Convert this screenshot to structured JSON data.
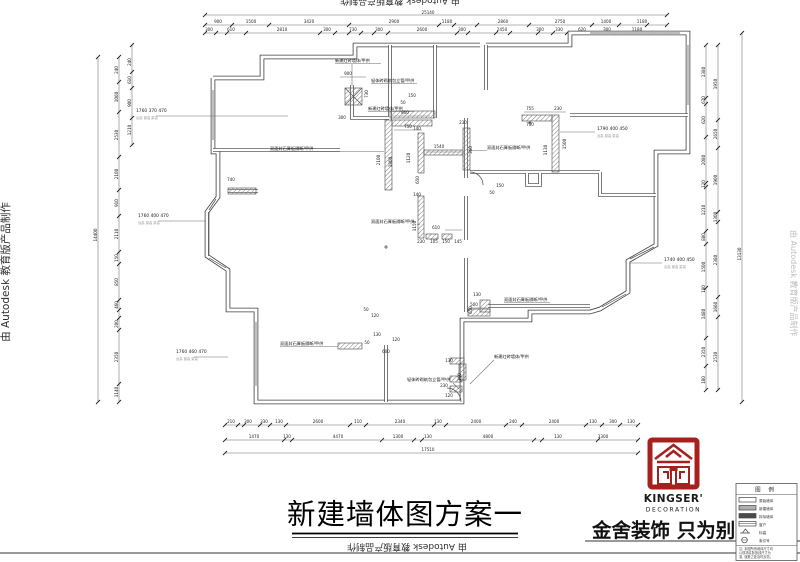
{
  "watermark": {
    "left": "由 Autodesk 教育版产品制作",
    "right": "由 Autodesk 教育版产品制作",
    "top": "由 Autodesk 教育版产品制作",
    "bottom": "由 Autodesk 教育版产品制作"
  },
  "titleblock": {
    "title": "新建墙体图方案一"
  },
  "brand": {
    "name": "KINGSER'",
    "sub": "DECORATION",
    "slogan": "金舍装饰 只为别墅而生",
    "logo_color": "#a8201e"
  },
  "legend": {
    "header": "图 例",
    "rows": [
      "原始墙体",
      "新建墙体",
      "拆除墙体",
      "窗户",
      "标高",
      "索引号"
    ],
    "note1": "注: 本图所有墙体尺寸均",
    "note2": "以现场实际放线尺寸为",
    "note3": "准, 误差之处及时反馈。"
  },
  "plan": {
    "wall_labels": [
      {
        "t": "新建红砖墙体/甲供",
        "x": 335,
        "y": 62
      },
      {
        "t": "轻体砖砌筑包立管/甲供",
        "x": 371,
        "y": 82
      },
      {
        "t": "新建红砖墙体/甲供",
        "x": 368,
        "y": 110
      },
      {
        "t": "双面封石膏板隔断/甲供",
        "x": 270,
        "y": 150
      },
      {
        "t": "双面封石膏板隔断/甲供",
        "x": 487,
        "y": 149
      },
      {
        "t": "双面封石膏板隔断/甲供",
        "x": 371,
        "y": 223
      },
      {
        "t": "双面封石膏板隔断/甲供",
        "x": 504,
        "y": 301
      },
      {
        "t": "双面封石膏板隔断/甲供",
        "x": 280,
        "y": 345
      },
      {
        "t": "新建红砖墙体/甲供",
        "x": 494,
        "y": 358
      },
      {
        "t": "轻体砖砌筑包立管/甲供",
        "x": 407,
        "y": 381
      }
    ],
    "callout_nums": [
      {
        "t": "1760 370 470",
        "x": 136,
        "y": 112
      },
      {
        "t": "1760 400 470",
        "x": 138,
        "y": 217
      },
      {
        "t": "1760 460 470",
        "x": 176,
        "y": 353
      },
      {
        "t": "1790 400 450",
        "x": 597,
        "y": 130
      },
      {
        "t": "1740 400 450",
        "x": 664,
        "y": 261
      }
    ],
    "callout_subs": [
      {
        "t": "台高 窗高 梁高",
        "x": 136,
        "y": 119
      },
      {
        "t": "台高 窗高 梁高",
        "x": 138,
        "y": 224
      },
      {
        "t": "台高 窗高 梁高",
        "x": 176,
        "y": 360
      },
      {
        "t": "台高 窗高 梁高",
        "x": 597,
        "y": 137
      },
      {
        "t": "台高 窗高 梁高",
        "x": 664,
        "y": 268
      }
    ],
    "dims_top": [
      {
        "t": "25140",
        "x": 428,
        "y": 14
      },
      {
        "t": "900",
        "x": 218,
        "y": 23
      },
      {
        "t": "1500",
        "x": 251,
        "y": 23
      },
      {
        "t": "3420",
        "x": 309,
        "y": 23
      },
      {
        "t": "2900",
        "x": 394,
        "y": 23
      },
      {
        "t": "1180",
        "x": 447,
        "y": 23
      },
      {
        "t": "2860",
        "x": 503,
        "y": 23
      },
      {
        "t": "2750",
        "x": 560,
        "y": 23
      },
      {
        "t": "1400",
        "x": 606,
        "y": 23
      },
      {
        "t": "1180",
        "x": 642,
        "y": 23
      },
      {
        "t": "300",
        "x": 209,
        "y": 31
      },
      {
        "t": "610",
        "x": 231,
        "y": 31
      },
      {
        "t": "2810",
        "x": 282,
        "y": 31
      },
      {
        "t": "300",
        "x": 327,
        "y": 31
      },
      {
        "t": "730",
        "x": 353,
        "y": 31
      },
      {
        "t": "300",
        "x": 379,
        "y": 31
      },
      {
        "t": "2600",
        "x": 422,
        "y": 31
      },
      {
        "t": "300",
        "x": 462,
        "y": 31
      },
      {
        "t": "2450",
        "x": 502,
        "y": 31
      },
      {
        "t": "300",
        "x": 540,
        "y": 31
      },
      {
        "t": "330",
        "x": 559,
        "y": 31
      },
      {
        "t": "620",
        "x": 582,
        "y": 31
      },
      {
        "t": "300",
        "x": 607,
        "y": 31
      },
      {
        "t": "1180",
        "x": 637,
        "y": 31
      }
    ],
    "dims_bottom": [
      {
        "t": "210",
        "x": 231,
        "y": 423
      },
      {
        "t": "300",
        "x": 248,
        "y": 423
      },
      {
        "t": "330",
        "x": 264,
        "y": 423
      },
      {
        "t": "130",
        "x": 279,
        "y": 423
      },
      {
        "t": "2600",
        "x": 318,
        "y": 423
      },
      {
        "t": "110",
        "x": 358,
        "y": 423
      },
      {
        "t": "2340",
        "x": 400,
        "y": 423
      },
      {
        "t": "130",
        "x": 438,
        "y": 423
      },
      {
        "t": "2400",
        "x": 476,
        "y": 423
      },
      {
        "t": "240",
        "x": 513,
        "y": 423
      },
      {
        "t": "2400",
        "x": 554,
        "y": 423
      },
      {
        "t": "130",
        "x": 593,
        "y": 423
      },
      {
        "t": "300",
        "x": 613,
        "y": 423
      },
      {
        "t": "130",
        "x": 631,
        "y": 423
      },
      {
        "t": "1470",
        "x": 254,
        "y": 438
      },
      {
        "t": "130",
        "x": 287,
        "y": 438
      },
      {
        "t": "4470",
        "x": 338,
        "y": 438
      },
      {
        "t": "1300",
        "x": 398,
        "y": 438
      },
      {
        "t": "130",
        "x": 428,
        "y": 438
      },
      {
        "t": "4800",
        "x": 488,
        "y": 438
      },
      {
        "t": "130",
        "x": 558,
        "y": 438
      },
      {
        "t": "3300",
        "x": 603,
        "y": 438
      },
      {
        "t": "17510",
        "x": 428,
        "y": 451
      }
    ],
    "dims_left": [
      {
        "t": "14400",
        "x": 97,
        "y": 235,
        "r": -90
      },
      {
        "t": "240",
        "x": 118,
        "y": 70,
        "r": -90
      },
      {
        "t": "1060",
        "x": 118,
        "y": 97,
        "r": -90
      },
      {
        "t": "2530",
        "x": 118,
        "y": 135,
        "r": -90
      },
      {
        "t": "2100",
        "x": 118,
        "y": 174,
        "r": -90
      },
      {
        "t": "910",
        "x": 118,
        "y": 203,
        "r": -90
      },
      {
        "t": "2110",
        "x": 118,
        "y": 234,
        "r": -90
      },
      {
        "t": "150",
        "x": 118,
        "y": 258,
        "r": -90
      },
      {
        "t": "850",
        "x": 118,
        "y": 282,
        "r": -90
      },
      {
        "t": "460",
        "x": 118,
        "y": 305,
        "r": -90
      },
      {
        "t": "200",
        "x": 118,
        "y": 324,
        "r": -90
      },
      {
        "t": "2350",
        "x": 118,
        "y": 357,
        "r": -90
      },
      {
        "t": "1140",
        "x": 118,
        "y": 392,
        "r": -90
      },
      {
        "t": "240",
        "x": 131,
        "y": 62,
        "r": -90
      },
      {
        "t": "610",
        "x": 131,
        "y": 80,
        "r": -90
      },
      {
        "t": "900",
        "x": 131,
        "y": 103,
        "r": -90
      },
      {
        "t": "1210",
        "x": 131,
        "y": 130,
        "r": -90
      }
    ],
    "dims_right": [
      {
        "t": "1380",
        "x": 705,
        "y": 72,
        "r": -90
      },
      {
        "t": "670",
        "x": 705,
        "y": 100,
        "r": -90
      },
      {
        "t": "620",
        "x": 705,
        "y": 120,
        "r": -90
      },
      {
        "t": "2080",
        "x": 705,
        "y": 160,
        "r": -90
      },
      {
        "t": "120",
        "x": 705,
        "y": 184,
        "r": -90
      },
      {
        "t": "1210",
        "x": 705,
        "y": 210,
        "r": -90
      },
      {
        "t": "880",
        "x": 705,
        "y": 237,
        "r": -90
      },
      {
        "t": "1500",
        "x": 705,
        "y": 267,
        "r": -90
      },
      {
        "t": "180",
        "x": 705,
        "y": 289,
        "r": -90
      },
      {
        "t": "1480",
        "x": 705,
        "y": 314,
        "r": -90
      },
      {
        "t": "2350",
        "x": 705,
        "y": 352,
        "r": -90
      },
      {
        "t": "180",
        "x": 705,
        "y": 380,
        "r": -90
      },
      {
        "t": "1950",
        "x": 717,
        "y": 84,
        "r": -90
      },
      {
        "t": "2650",
        "x": 717,
        "y": 134,
        "r": -90
      },
      {
        "t": "1900",
        "x": 717,
        "y": 180,
        "r": -90
      },
      {
        "t": "1300",
        "x": 717,
        "y": 217,
        "r": -90
      },
      {
        "t": "2380",
        "x": 717,
        "y": 260,
        "r": -90
      },
      {
        "t": "1660",
        "x": 717,
        "y": 307,
        "r": -90
      },
      {
        "t": "2530",
        "x": 717,
        "y": 357,
        "r": -90
      },
      {
        "t": "13130",
        "x": 741,
        "y": 254,
        "r": -90
      }
    ],
    "dims_inner": [
      {
        "t": "900",
        "x": 348,
        "y": 75
      },
      {
        "t": "300",
        "x": 342,
        "y": 119
      },
      {
        "t": "730",
        "x": 368,
        "y": 94,
        "r": -90
      },
      {
        "t": "150",
        "x": 412,
        "y": 97
      },
      {
        "t": "50",
        "x": 403,
        "y": 104
      },
      {
        "t": "800",
        "x": 405,
        "y": 114
      },
      {
        "t": "750",
        "x": 408,
        "y": 128
      },
      {
        "t": "2100",
        "x": 380,
        "y": 160,
        "r": -90
      },
      {
        "t": "1800",
        "x": 392,
        "y": 162,
        "r": -90
      },
      {
        "t": "755",
        "x": 530,
        "y": 110
      },
      {
        "t": "230",
        "x": 558,
        "y": 110
      },
      {
        "t": "750",
        "x": 530,
        "y": 126
      },
      {
        "t": "1130",
        "x": 547,
        "y": 150,
        "r": -90
      },
      {
        "t": "1500",
        "x": 566,
        "y": 144,
        "r": -90
      },
      {
        "t": "230",
        "x": 463,
        "y": 124
      },
      {
        "t": "140",
        "x": 417,
        "y": 130
      },
      {
        "t": "1540",
        "x": 439,
        "y": 148
      },
      {
        "t": "1120",
        "x": 410,
        "y": 158,
        "r": -90
      },
      {
        "t": "650",
        "x": 419,
        "y": 180,
        "r": -90
      },
      {
        "t": "360",
        "x": 472,
        "y": 150,
        "r": -90
      },
      {
        "t": "140",
        "x": 417,
        "y": 196
      },
      {
        "t": "1150",
        "x": 416,
        "y": 226,
        "r": -90
      },
      {
        "t": "610",
        "x": 436,
        "y": 229
      },
      {
        "t": "230",
        "x": 421,
        "y": 243
      },
      {
        "t": "105",
        "x": 434,
        "y": 243
      },
      {
        "t": "150",
        "x": 446,
        "y": 243
      },
      {
        "t": "145",
        "x": 458,
        "y": 243
      },
      {
        "t": "500",
        "x": 474,
        "y": 306
      },
      {
        "t": "130",
        "x": 377,
        "y": 336
      },
      {
        "t": "50",
        "x": 367,
        "y": 344
      },
      {
        "t": "600",
        "x": 386,
        "y": 353
      },
      {
        "t": "120",
        "x": 396,
        "y": 341
      },
      {
        "t": "130",
        "x": 449,
        "y": 362
      },
      {
        "t": "360",
        "x": 461,
        "y": 377,
        "r": -90
      },
      {
        "t": "230",
        "x": 444,
        "y": 387
      },
      {
        "t": "120",
        "x": 449,
        "y": 397
      },
      {
        "t": "130",
        "x": 477,
        "y": 296
      },
      {
        "t": "650",
        "x": 472,
        "y": 310,
        "r": -90
      },
      {
        "t": "740",
        "x": 231,
        "y": 181
      },
      {
        "t": "50",
        "x": 366,
        "y": 311
      },
      {
        "t": "120",
        "x": 375,
        "y": 317
      },
      {
        "t": "150",
        "x": 500,
        "y": 187
      },
      {
        "t": "50",
        "x": 492,
        "y": 194
      }
    ]
  }
}
